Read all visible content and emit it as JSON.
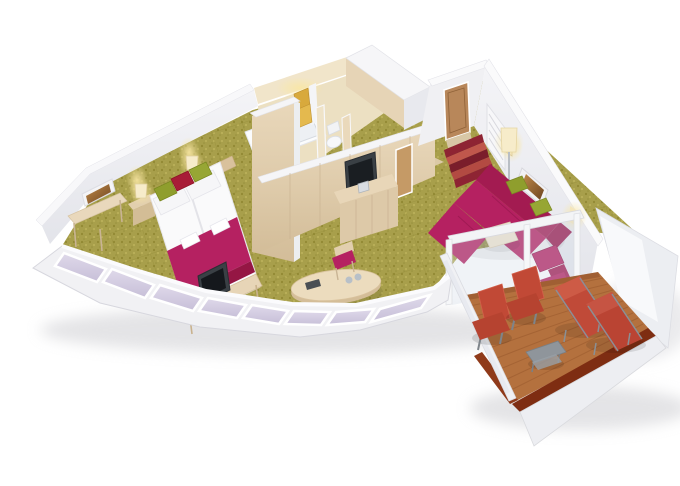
{
  "scene": {
    "type": "3d-cutaway-floor-plan",
    "view": "isometric-top-down",
    "background": "#ffffff",
    "rooms": {
      "bedroom": {
        "floor": "olive-carpet",
        "furniture": [
          "double-bed",
          "magenta-bed-runner",
          "white-towel-rolls",
          "green-cushions",
          "red-cushion",
          "nightstand-left",
          "nightstand-right",
          "table-lamp-left",
          "table-lamp-right",
          "wall-art",
          "console-desk",
          "tv-bench",
          "flat-tv",
          "headboard-panel"
        ]
      },
      "bathroom": {
        "floor": "cream-tile",
        "fixtures": [
          "bathtub",
          "chrome-faucet",
          "gold-towels",
          "shower-partition",
          "toilet",
          "wc-divider-wall"
        ]
      },
      "entry": {
        "floor": "olive-carpet-and-wood-vestibule",
        "items": [
          "entry-door",
          "striped-runner-rug",
          "louvered-closet-door",
          "bathroom-door",
          "wall-lamp"
        ]
      },
      "living_room": {
        "floor": "olive-carpet",
        "furniture": [
          "l-shaped-sofa",
          "sofa-green-cushion-1",
          "sofa-green-cushion-2",
          "ottoman",
          "armchair",
          "coffee-table",
          "oval-dining-table",
          "dining-chair",
          "wall-tv",
          "sideboard",
          "ice-bucket",
          "floor-lamp",
          "wall-sconce",
          "wall-art"
        ]
      },
      "balcony": {
        "floor": "wood-plank-deck",
        "railing": "white-railing-dark-wood-cap",
        "furniture": [
          "deck-chair-1",
          "deck-chair-2",
          "sun-lounger-1",
          "sun-lounger-2",
          "side-table"
        ],
        "glass_doors": 2
      },
      "hull_side": {
        "window_panes": 8,
        "wall": "curved-white-band"
      }
    }
  },
  "palette": {
    "carpet": "#a89f4b",
    "carpet_dark": "#8d852f",
    "carpet_light": "#c1b75f",
    "wall_white": "#f2f2f5",
    "wall_shade": "#e7e8ed",
    "wall_cap": "#f8f8fa",
    "wood_light": "#e6d4b6",
    "wood_mid": "#ddc9a8",
    "bathroom_cream": "#ece0c2",
    "bathroom_wall": "#f1e5ca",
    "magenta": "#b52161",
    "magenta_dark": "#a31b51",
    "magenta_deep": "#951644",
    "green_pillow": "#8f9e2d",
    "green_pillow2": "#97a634",
    "red_pillow": "#a81c37",
    "deck_wood": "#b4713e",
    "deck_plank_line": "#9d5c2f",
    "deck_rail_cap": "#7e2d12",
    "lounger_red": "#c04a38",
    "lounger_red2": "#ba4433",
    "chair_red": "#c14936",
    "window_pane": "#d6cfe3",
    "rug_red": "#8e2433",
    "rug_stripe": "#c0574c",
    "rug_stripe_dark": "#7a1d2b",
    "rug_stripe_mid": "#b34a42",
    "gold_towel": "#d8a93c",
    "gold_towel2": "#e4b94e",
    "tv_dark": "#3a4045",
    "door_wood": "#b8875a",
    "lamp_glow": "#f7e09a",
    "tub_white": "#fbfcfd",
    "metal_gray": "#8f959b"
  }
}
